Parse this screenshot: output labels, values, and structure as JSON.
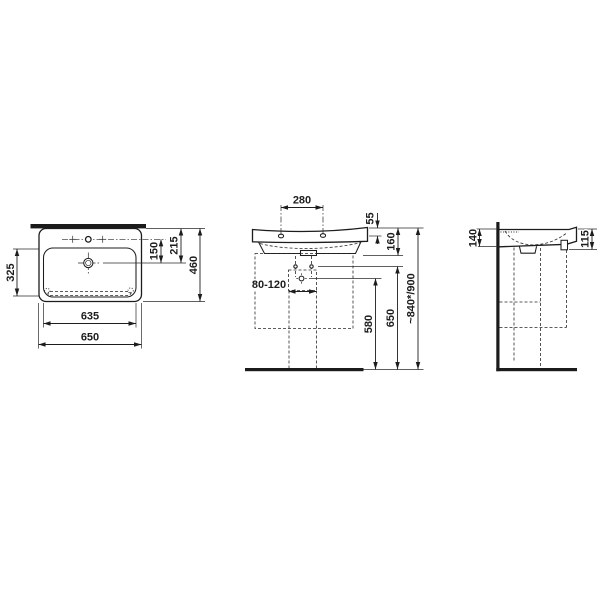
{
  "drawing_type": "washbasin-technical-dimension-drawing",
  "colors": {
    "ink": "#1d1d1d",
    "background": "#ffffff"
  },
  "views": {
    "top": {
      "dims": {
        "overall_width": "650",
        "bowl_width": "635",
        "overall_depth": "460",
        "bowl_depth": "325",
        "tap_to_drain": "150",
        "front_to_drain": "215"
      }
    },
    "front": {
      "dims": {
        "tap_hole_spacing": "280",
        "rim_to_tap_hole": "55",
        "apron_height": "160",
        "waste_range": "80-120",
        "waste_height": "580",
        "fixing_height": "650",
        "rim_height": "~840*/900"
      }
    },
    "side": {
      "dims": {
        "rear_edge_height": "140",
        "front_edge_height": "115"
      }
    }
  }
}
